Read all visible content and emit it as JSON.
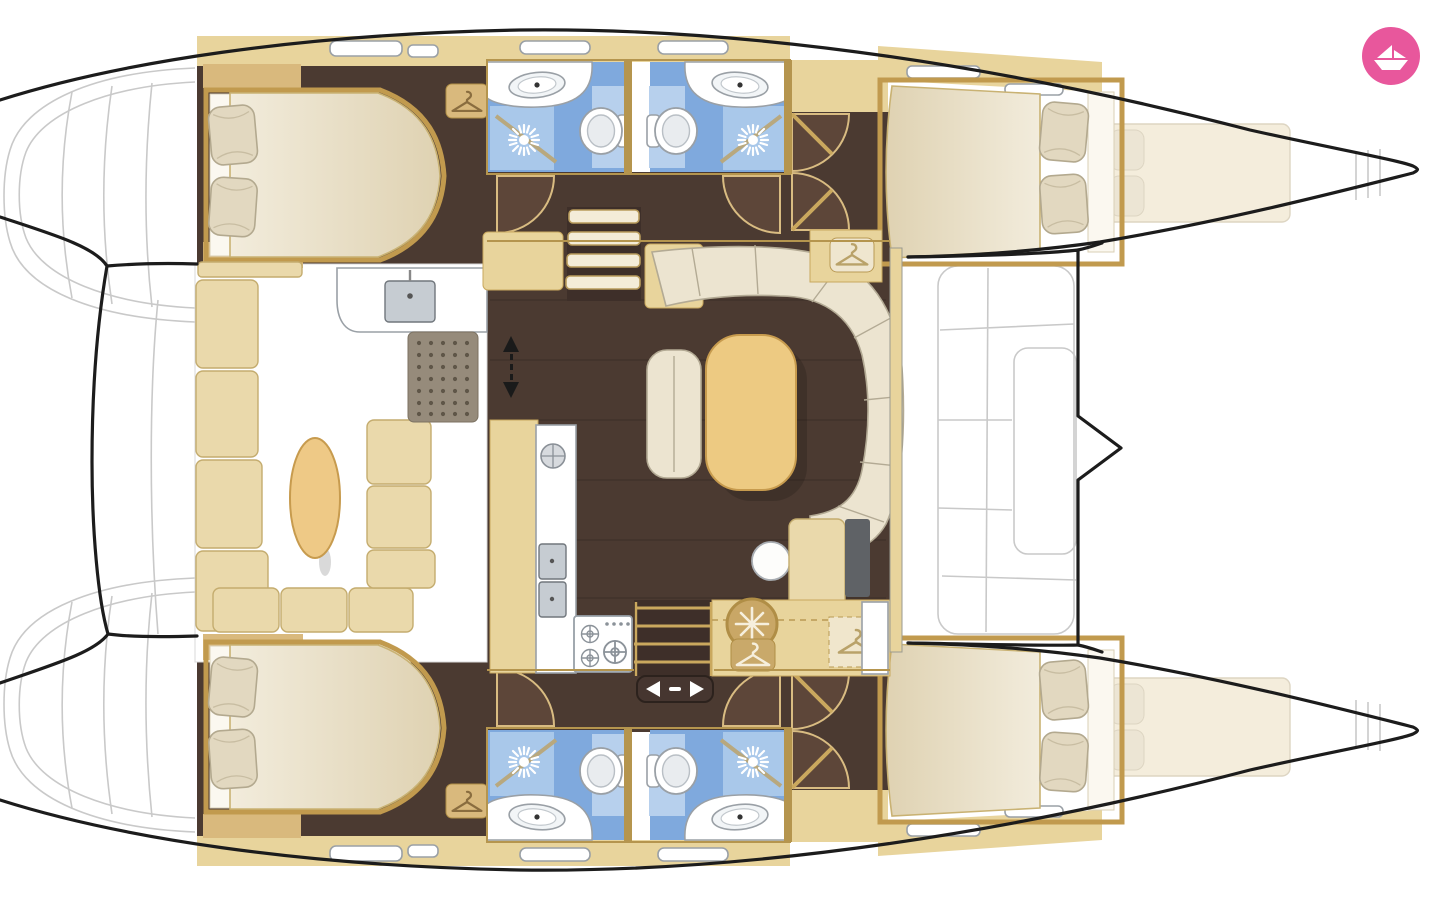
{
  "app": {
    "name": "Catamaran interior layout floor plan",
    "logo_icon": "paper-boat-icon"
  },
  "colors": {
    "hull": "#1c1c1c",
    "deck_line": "#c9c9c9",
    "floor": "#4b3a31",
    "floor_light": "#5d4639",
    "cabinet": "#e8d49c",
    "cabinet_dark": "#d9b97d",
    "frame": "#b5954e",
    "dinette": "#ead9ab",
    "mattress_light": "#f2ecdc",
    "mattress_dark": "#dfd2b2",
    "pillow": "#e2d8c0",
    "sofa": "#ece4d0",
    "sofa_line": "#b3aa94",
    "table": "#edca82",
    "table_line": "#c79b4e",
    "bath_floor": "#7fa9dd",
    "bath_panel": "#b7d0ed",
    "shower": "#a9c8ea",
    "mat": "#968b7b",
    "mat_dot": "#5f5648",
    "nav_seat": "#5f6266",
    "logo_pink": "#e8579c",
    "logo_boat": "#ffffff"
  },
  "icons": {
    "wardrobe": "hanger-icon",
    "fridge": "snowflake-icon",
    "shower": "shower-spray-icon",
    "companionway": "up-down-arrows-icon",
    "sliding_door": "left-right-arrows-icon",
    "logo": "paper-boat-icon"
  },
  "layout": {
    "type": "catamaran-floor-plan",
    "hulls": 2,
    "cabins": 4,
    "bathrooms": 4,
    "features": [
      "double-beds",
      "showers",
      "toilets",
      "sinks",
      "galley-stove",
      "galley-sinks",
      "fridge",
      "wardrobes",
      "u-shaped-sofa",
      "saloon-table",
      "dinette-settee",
      "oval-table",
      "stairs",
      "sliding-door",
      "forepeak-berths",
      "deck-sunpads",
      "transom-platforms"
    ]
  }
}
